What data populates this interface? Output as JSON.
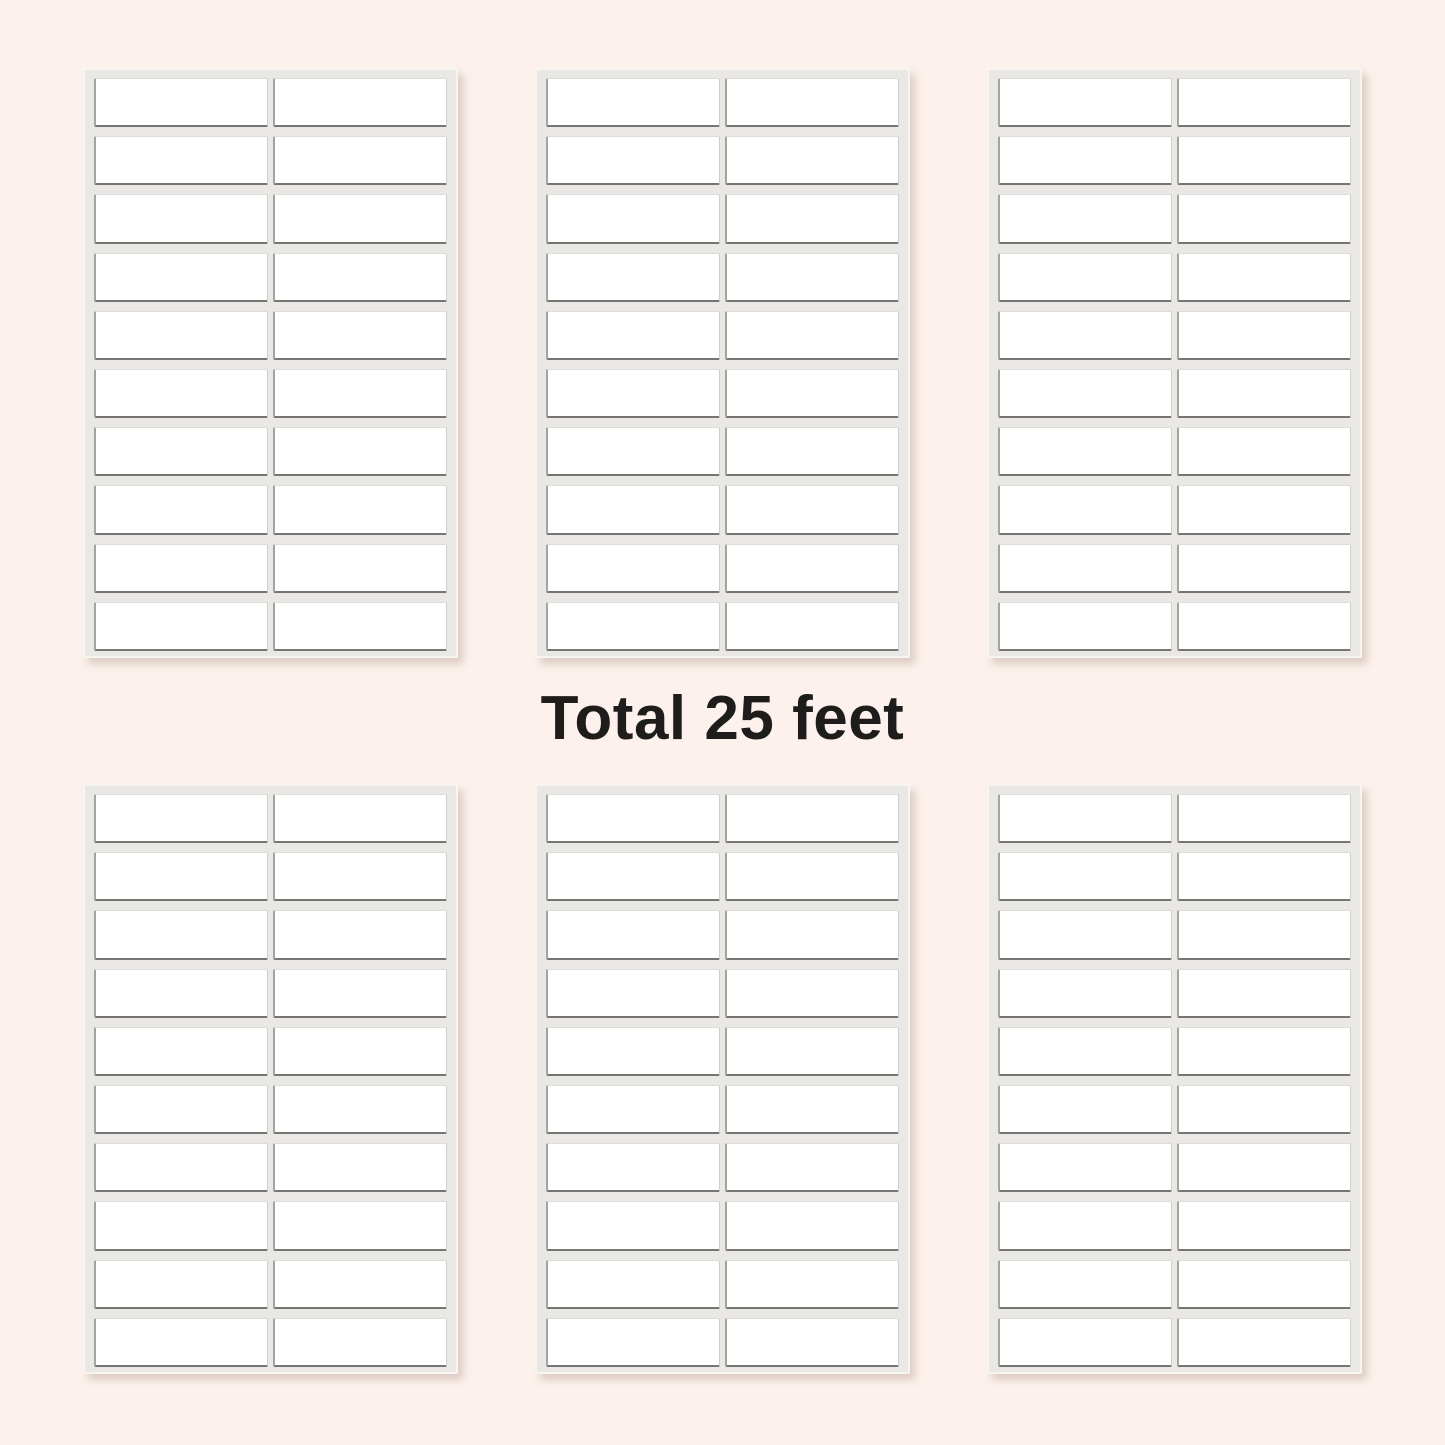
{
  "title": {
    "text": "Total 25 feet"
  },
  "colors": {
    "background": "#fcf1ec",
    "sheet_backing": "#eae8e5",
    "sheet_edge_highlight": "#f7f5f2",
    "sheet_shadow": "rgba(176,150,138,0.40)",
    "label_fill": "#ffffff",
    "label_border_top": "#dedcd9",
    "label_border_right": "#d0cdca",
    "label_border_bottom": "#777573",
    "label_border_left": "#a5a3a0",
    "title_text": "#1e1d1b"
  },
  "sheets": {
    "count": 6,
    "rows_of_sheets": 2,
    "sheets_per_row": 3,
    "label_rows": 10,
    "label_columns": 2,
    "labels_per_sheet": 20,
    "total_labels": 120
  }
}
